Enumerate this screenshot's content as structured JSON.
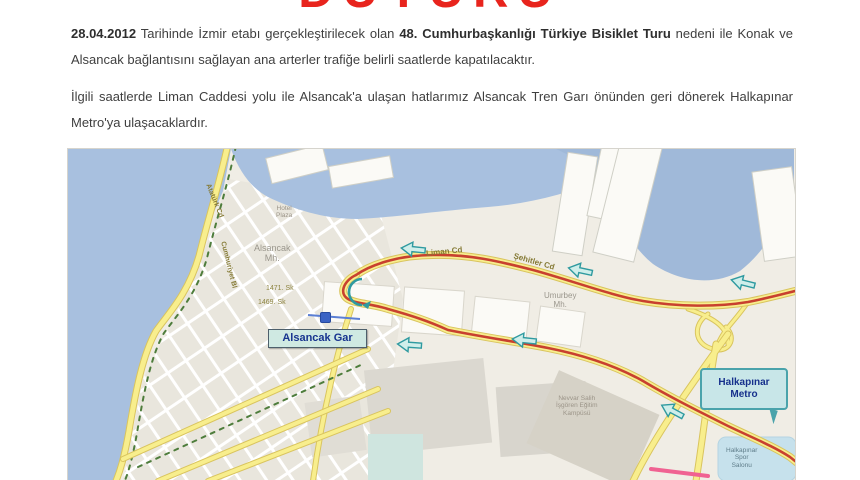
{
  "doc": {
    "title": "DUYURU",
    "title_color": "#e8241d",
    "p1": {
      "date": "28.04.2012",
      "text1": " Tarihinde İzmir etabı gerçekleştirilecek olan ",
      "bold": "48. Cumhurbaşkanlığı Türkiye Bisiklet Turu",
      "text2": " nedeni ile Konak ve Alsancak bağlantısını sağlayan ana arterler trafiğe belirli saatlerde kapatılacaktır."
    },
    "p2": "İlgili saatlerde Liman Caddesi yolu ile Alsancak'a ulaşan hatlarımız Alsancak Tren Garı önünden geri dönerek Halkapınar Metro'ya ulaşacaklardır."
  },
  "map": {
    "callouts": {
      "alsancak_gar": "Alsancak Gar",
      "halkapinar_metro": "Halkapınar\nMetro"
    },
    "roads": {
      "liman_cd": "Liman Cd",
      "sehitler_cd": "Şehitler Cd",
      "ataturk_cd": "Atatürk Cd",
      "cumhuriyet_bl": "Cumhuriyet Bl"
    },
    "areas": {
      "alsancak_mh": "Alsancak\nMh.",
      "umurbey_mh": "Umurbey\nMh."
    },
    "streets": {
      "sk_1471": "1471. Sk",
      "sk_1469": "1469. Sk"
    },
    "pois": {
      "hotel_plaza": "Hotel\nPlaza",
      "kampus": "Nevvar Salih\nİşgören Eğitim\nKampüsü",
      "spor": "Halkapınar\nSpor\nSalonu"
    },
    "colors": {
      "water": "#a8c0df",
      "land": "#f0ede5",
      "road_fill": "#f8ee8d",
      "road_casing": "#d9c45e",
      "route_red": "#c8402f",
      "arrow_teal": "#2f9aa0",
      "callout_bg": "#c8e6e8",
      "pink_line": "#f06292"
    }
  }
}
